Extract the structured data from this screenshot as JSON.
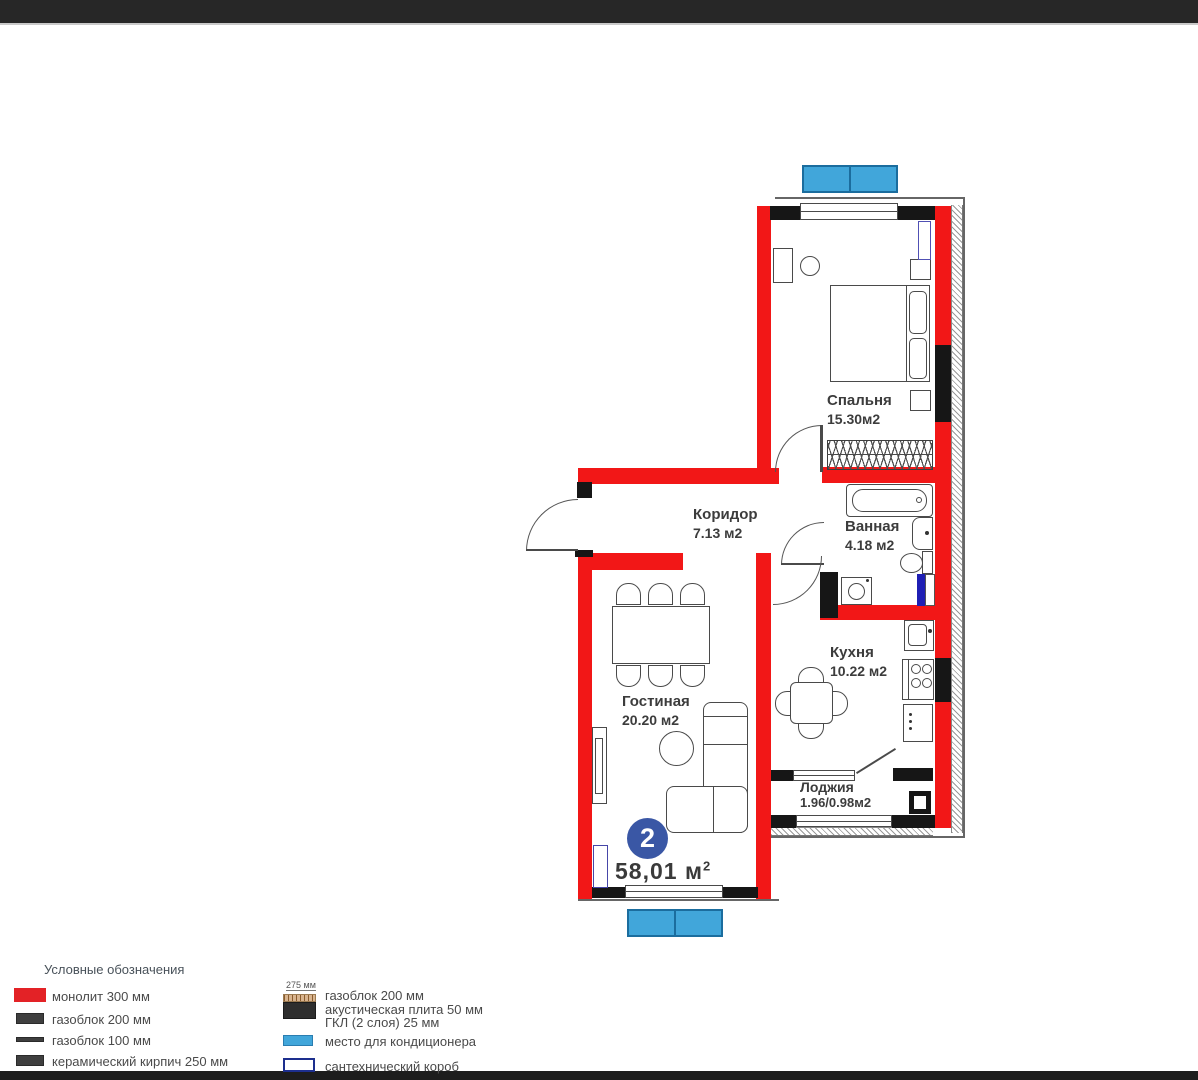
{
  "plan": {
    "badge": "2",
    "total": {
      "value": "58,01",
      "unit": "м",
      "sup": "2"
    },
    "rooms": {
      "bedroom": {
        "name": "Спальня",
        "area": "15.30м2"
      },
      "corridor": {
        "name": "Коридор",
        "area": "7.13 м2"
      },
      "bathroom": {
        "name": "Ванная",
        "area": "4.18 м2"
      },
      "kitchen": {
        "name": "Кухня",
        "area": "10.22 м2"
      },
      "living": {
        "name": "Гостиная",
        "area": "20.20 м2"
      },
      "loggia": {
        "name": "Лоджия",
        "area": "1.96/0.98м2"
      }
    },
    "colors": {
      "wall_monolith": "#f21717",
      "wall_black": "#161616",
      "ac_blue": "#41a6da",
      "badge_blue": "#3a57a5",
      "plumbing_blue": "#1f1fb4"
    }
  },
  "legend": {
    "title": "Условные обозначения",
    "monolit": "монолит 300 мм",
    "gazoblok200": "газоблок 200 мм",
    "gazoblok100": "газоблок 100 мм",
    "kirpich": "керамический кирпич 250 мм",
    "layered_dim": "275 мм",
    "layered_line1": "газоблок 200 мм",
    "layered_line2": "акустическая плита 50 мм",
    "layered_line3": "ГКЛ (2 слоя) 25 мм",
    "ac": "место для кондиционера",
    "plumbing": "сантехнический короб"
  }
}
